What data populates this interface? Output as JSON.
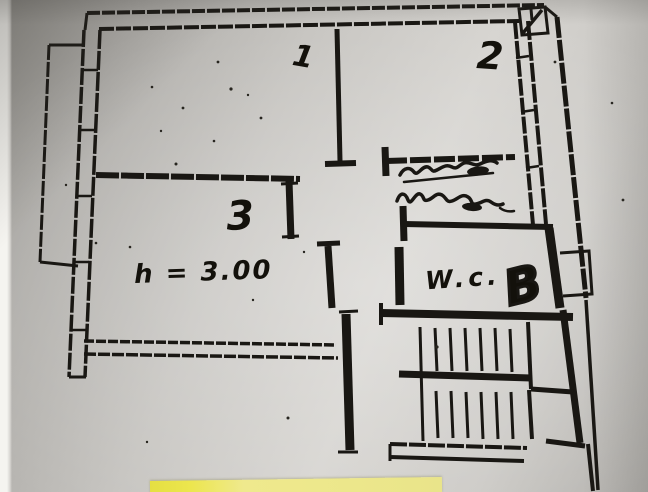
{
  "document_type": "photographed hand-drawn apartment floor plan",
  "labels": {
    "room_1": "1",
    "room_2": "2",
    "room_3": "3",
    "height_note": "h = 3.00",
    "wc": "W.c.",
    "handwritten_b": "B"
  },
  "annotations": {
    "scribble": "illegible two-line handwritten note above W.C. room",
    "door_symbol_top_right": "small box with diagonal stroke"
  },
  "features": {
    "staircase": "double flight with landing, bottom right",
    "balcony_left": "narrow balcony strip on left side",
    "balcony_right": "narrow balcony strip on right side"
  },
  "colors": {
    "ink": "#1d1b17",
    "paper_gray": "#c9c7c3",
    "sticky_note_yellow": "#e9e259",
    "paper_edge_white": "#f3f2ee"
  }
}
